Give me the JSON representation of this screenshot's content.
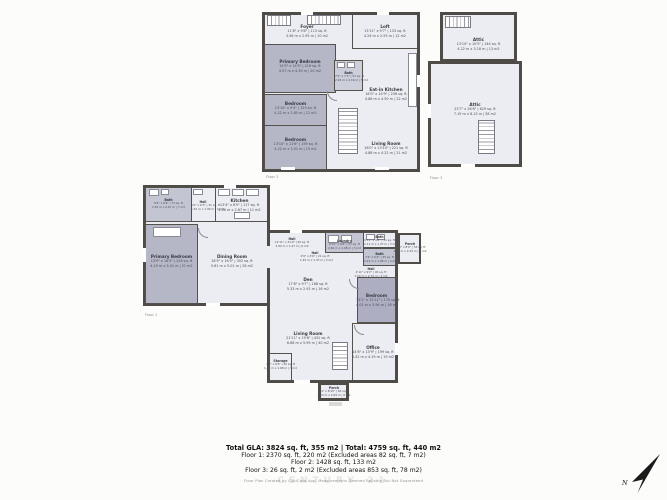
{
  "palette": {
    "wall": "#4f4c48",
    "floor_light": "#ecedf2",
    "floor_shaded": "#c3c5d2",
    "bedroom_shaded": "#b5b7c6",
    "bedroom_dark": "#adaec2",
    "label_text": "#3a3a44",
    "caption_text": "#8d8d8d",
    "summary_text": "#101010",
    "compass": "#1a1a1a"
  },
  "summary": {
    "line1": "Total GLA: 3824 sq. ft, 355 m2 | Total: 4759 sq. ft, 440 m2",
    "line2": "Floor 1: 2370 sq. ft, 220 m2 (Excluded areas 82 sq. ft, 7 m2)",
    "line3": "Floor 2: 1428 sq. ft, 133 m2",
    "line4": "Floor 3: 26 sq. ft, 2 m2 (Excluded areas 853 sq. ft, 78 m2)",
    "disclaimer": "Floor Plan Created by CubiCasa App, Measurements Deemed Reliable But Not Guaranteed",
    "watermark": "CENTURY 21"
  },
  "compass": {
    "label": "N"
  },
  "floors": {
    "floor1": {
      "caption": "Floor 1",
      "rooms": {
        "bath_left": {
          "name": "Bath",
          "imperial": "8'4\" x 8'9\" | 73 sq. ft",
          "metric": "2.54 m x 2.67 m | 7 m2"
        },
        "hall_top": {
          "name": "Hall",
          "imperial": "5'0\" x 6'3\" | 31 sq. ft",
          "metric": "1.52 m x 1.90 m | 3 m2"
        },
        "kitchen": {
          "name": "Kitchen",
          "imperial": "13'4\" x 8'9\" | 117 sq. ft",
          "metric": "4.06 m x 2.67 m | 11 m2"
        },
        "primary_bedroom": {
          "name": "Primary Bedroom",
          "imperial": "13'9\" x 16'5\" | 226 sq. ft",
          "metric": "4.19 m x 5.01 m | 21 m2"
        },
        "dining_room": {
          "name": "Dining Room",
          "imperial": "18'5\" x 16'5\" | 302 sq. ft",
          "metric": "5.61 m x 5.01 m | 28 m2"
        },
        "hall_center": {
          "name": "Hall",
          "imperial": "12'11\" x 4'10\" | 62 sq. ft",
          "metric": "3.94 m x 1.47 m | 6 m2"
        },
        "hall_small": {
          "name": "Hall",
          "imperial": "4'9\" x 4'6\" | 21 sq. ft",
          "metric": "1.45 m x 1.37 m | 2 m2"
        },
        "laundry": {
          "name": "Laundry",
          "imperial": "8'10\" x 6'6\" | 57 sq. ft",
          "metric": "2.69 m x 1.98 m | 5 m2"
        },
        "bath_top": {
          "name": "Bath",
          "imperial": "6'11\" x 4'6\" | 31 sq. ft",
          "metric": "2.11 m x 1.37 m | 3 m2"
        },
        "bath_mid": {
          "name": "Bath",
          "imperial": "7'4\" x 6'2\" | 45 sq. ft",
          "metric": "2.24 m x 1.88 m | 4 m2"
        },
        "hall_right": {
          "name": "Hall",
          "imperial": "4'11\" x 9'2\" | 45 sq. ft",
          "metric": "1.50 m x 2.79 m | 4 m2"
        },
        "den": {
          "name": "Den",
          "imperial": "17'6\" x 9'7\" | 168 sq. ft",
          "metric": "5.33 m x 2.92 m | 16 m2"
        },
        "bedroom": {
          "name": "Bedroom",
          "imperial": "13'2\" x 12'11\" | 170 sq. ft",
          "metric": "4.01 m x 3.94 m | 16 m2"
        },
        "living_room": {
          "name": "Living Room",
          "imperial": "21'11\" x 19'8\" | 431 sq. ft",
          "metric": "6.68 m x 5.99 m | 40 m2"
        },
        "office": {
          "name": "Office",
          "imperial": "14'6\" x 13'9\" | 199 sq. ft",
          "metric": "4.42 m x 4.19 m | 19 m2"
        },
        "storage": {
          "name": "Storage",
          "imperial": "4'8\" x 6'6\" | 30 sq. ft",
          "metric": "1.42 m x 1.98 m | 3 m2"
        },
        "entry_porch": {
          "name": "Porch",
          "imperial": "6'10\" x 8'0\" | 55 sq. ft",
          "metric": "2.08 m x 2.44 m | 5 m2"
        },
        "porch": {
          "name": "Porch",
          "imperial": "7'4\" x 8'10\" | 65 sq. ft",
          "metric": "2.24 m x 2.69 m | 6 m2"
        }
      }
    },
    "floor2": {
      "caption": "Floor 2",
      "rooms": {
        "foyer": {
          "name": "Foyer",
          "imperial": "11'8\" x 9'8\" | 113 sq. ft",
          "metric": "3.56 m x 2.95 m | 10 m2"
        },
        "loft": {
          "name": "Loft",
          "imperial": "13'11\" x 9'7\" | 133 sq. ft",
          "metric": "4.24 m x 2.93 m | 12 m2"
        },
        "primary_bedroom": {
          "name": "Primary Bedroom",
          "imperial": "15'0\" x 14'5\" | 216 sq. ft",
          "metric": "4.57 m x 4.39 m | 20 m2"
        },
        "bath": {
          "name": "Bath",
          "imperial": "7'5\" x 7'1\" | 53 sq. ft",
          "metric": "2.26 m x 2.16 m | 5 m2"
        },
        "eat_in_kitchen": {
          "name": "Eat-in Kitchen",
          "imperial": "16'0\" x 14'9\" | 236 sq. ft",
          "metric": "4.88 m x 4.50 m | 22 m2"
        },
        "bedroom_a": {
          "name": "Bedroom",
          "imperial": "13'10\" x 9'4\" | 129 sq. ft",
          "metric": "4.22 m x 2.85 m | 12 m2"
        },
        "bedroom_b": {
          "name": "Bedroom",
          "imperial": "13'10\" x 11'6\" | 159 sq. ft",
          "metric": "4.22 m x 3.51 m | 15 m2"
        },
        "living_room": {
          "name": "Living Room",
          "imperial": "16'0\" x 13'10\" | 221 sq. ft",
          "metric": "4.88 m x 4.22 m | 21 m2"
        }
      }
    },
    "floor3": {
      "caption": "Floor 3",
      "rooms": {
        "attic_upper": {
          "name": "Attic",
          "imperial": "13'10\" x 10'5\" | 144 sq. ft",
          "metric": "4.22 m x 3.18 m | 13 m2"
        },
        "attic_lower": {
          "name": "Attic",
          "imperial": "23'7\" x 26'8\" | 629 sq. ft",
          "metric": "7.19 m x 8.13 m | 58 m2"
        }
      }
    }
  }
}
